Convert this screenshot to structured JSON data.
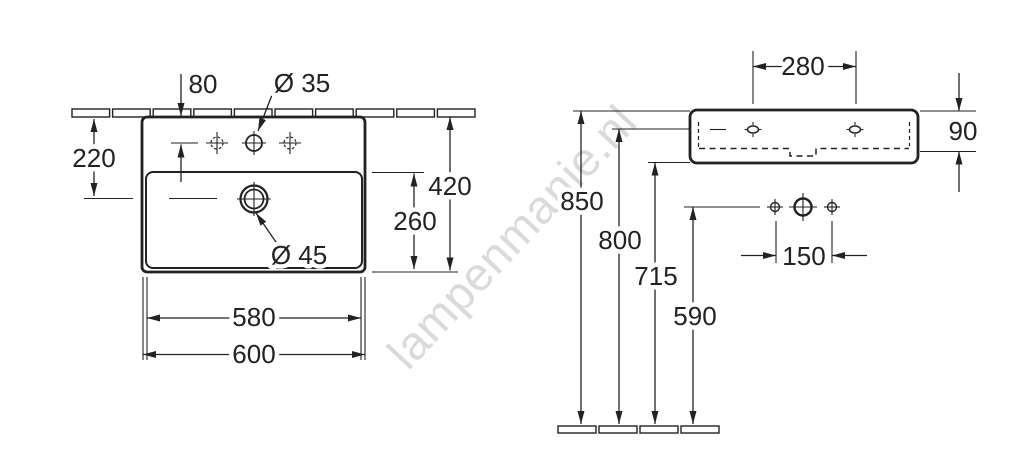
{
  "watermark": {
    "text": "lampenmanie.nl",
    "color": "#bdbdbd"
  },
  "drawing": {
    "line_color": "#222222",
    "top_view": {
      "dims": {
        "tap_offset": "80",
        "tap_diameter": "Ø 35",
        "back_to_drain": "220",
        "total_depth": "420",
        "basin_depth": "260",
        "drain_diameter": "Ø 45",
        "inner_width": "580",
        "outer_width": "600"
      }
    },
    "front_view": {
      "dims": {
        "mounting_hole_spacing": "280",
        "body_height": "90",
        "rim_height": "850",
        "mounting_height": "800",
        "underside_height": "715",
        "connection_height": "590",
        "supply_spacing": "150"
      }
    }
  }
}
